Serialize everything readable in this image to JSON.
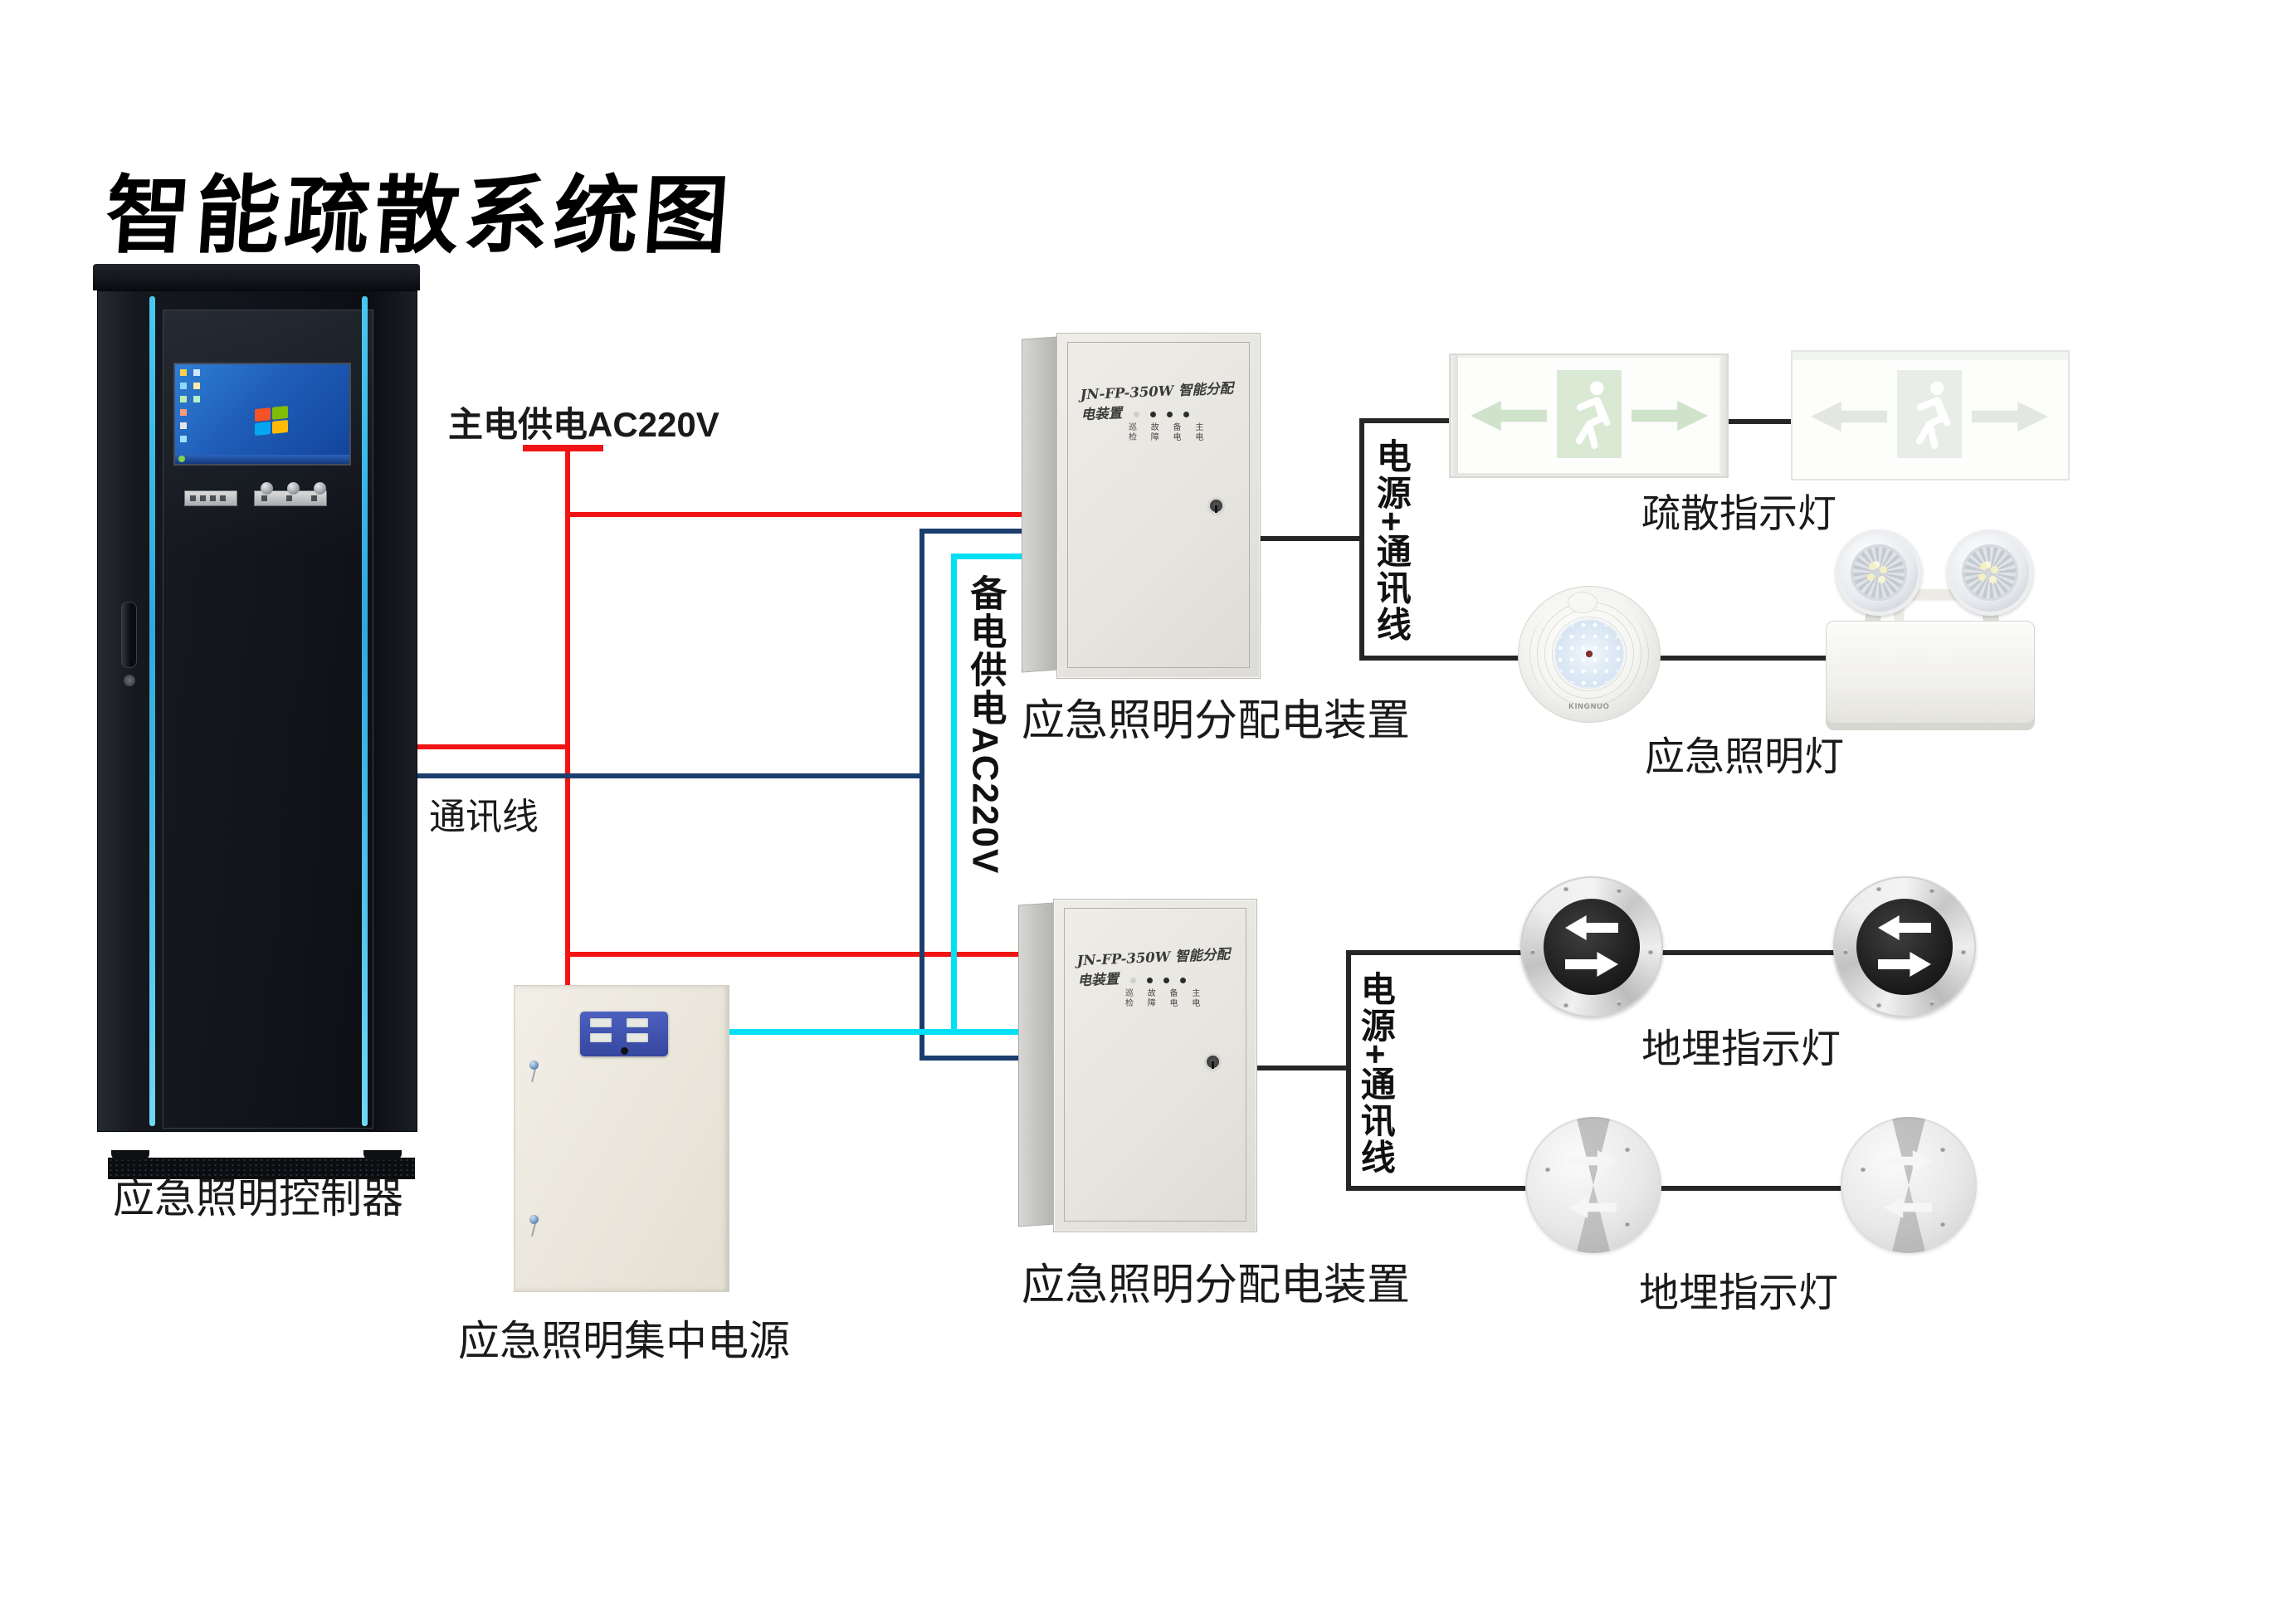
{
  "title": "智能疏散系统图",
  "colors": {
    "wire_red": "#f21414",
    "wire_navy": "#1b3e6e",
    "wire_cyan": "#00e0f5",
    "wire_black": "#262626",
    "cabinet_accent": "#3fc0ea",
    "exit_green": "#d3e5cf",
    "panel_blue": "#4054b2"
  },
  "cabinet": {
    "label": "应急照明控制器"
  },
  "power_labels": {
    "main_ac": "主电供电AC220V",
    "backup_ac": "备电供电AC220V",
    "comm": "通讯线",
    "power_comm_1": "电源+通讯线",
    "power_comm_2": "电源+通讯线"
  },
  "boxes": {
    "dist1": {
      "title": "JN-FP-350W 智能分配电装置",
      "led_row1": "巡 故 备 主",
      "led_row2": "检 障 电 电",
      "label": "应急照明分配电装置"
    },
    "dist2": {
      "title": "JN-FP-350W 智能分配电装置",
      "led_row1": "巡 故 备 主",
      "led_row2": "检 障 电 电",
      "label": "应急照明分配电装置"
    },
    "central_power": {
      "label": "应急照明集中电源"
    }
  },
  "lights": {
    "exit": {
      "label": "疏散指示灯"
    },
    "emergency": {
      "label": "应急照明灯",
      "brand": "KINGNUO"
    },
    "ground_top": {
      "label": "地埋指示灯"
    },
    "ground_bottom": {
      "label": "地埋指示灯"
    }
  }
}
